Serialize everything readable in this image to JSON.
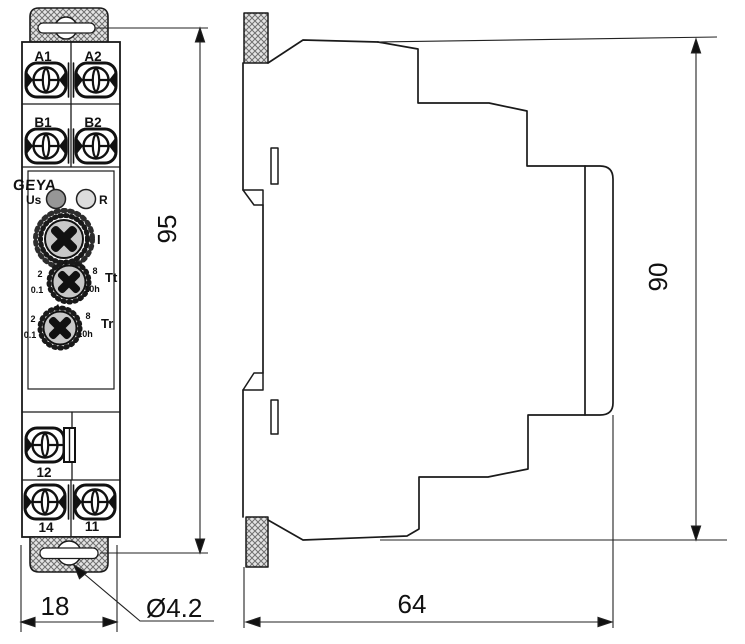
{
  "device": {
    "brand": "GEYA",
    "front": {
      "terminals_top": [
        "A1",
        "A2",
        "B1",
        "B2"
      ],
      "leds": [
        "Us",
        "R"
      ],
      "dials": [
        "I",
        "Tt",
        "Tr"
      ],
      "dial_scale": {
        "v0": "0.1",
        "v2": "2",
        "v4": "4",
        "v8": "8",
        "vmax": "10h"
      },
      "terminals_bottom": [
        "12",
        "14",
        "11"
      ]
    }
  },
  "dimensions": {
    "front_height": "95",
    "front_width": "18",
    "hole_diameter": "Ø4.2",
    "side_depth": "64",
    "side_height": "90"
  },
  "colors": {
    "line": "#1a1a1a",
    "hatch": "#6f6f6f",
    "led_us": "#969696",
    "led_r": "#dcdcdc",
    "knob": "#c8c8c8",
    "paper": "#ffffff"
  }
}
